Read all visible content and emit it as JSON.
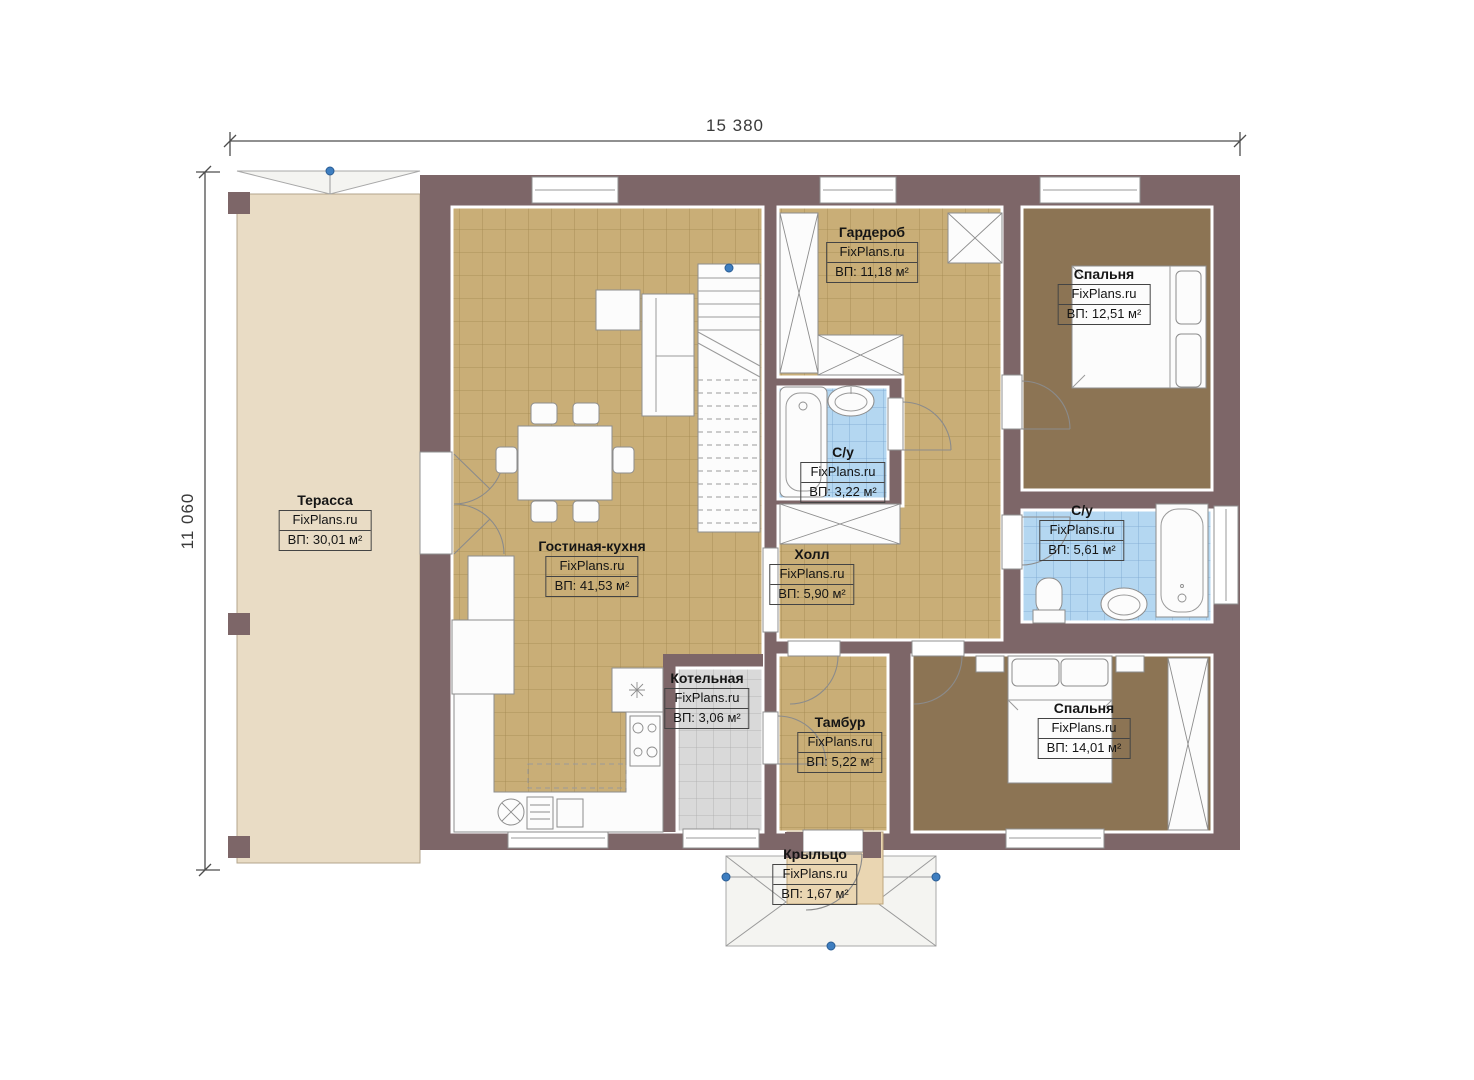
{
  "dimensions": {
    "width_label": "15 380",
    "height_label": "11 060"
  },
  "watermark": "FixPlans.ru",
  "rooms": [
    {
      "name": "Терасса",
      "brand": "FixPlans.ru",
      "area": "ВП: 30,01 м²"
    },
    {
      "name": "Гостиная-кухня",
      "brand": "FixPlans.ru",
      "area": "ВП: 41,53 м²"
    },
    {
      "name": "Гардероб",
      "brand": "FixPlans.ru",
      "area": "ВП: 11,18 м²"
    },
    {
      "name": "Спальня",
      "brand": "FixPlans.ru",
      "area": "ВП: 12,51 м²"
    },
    {
      "name": "С/у",
      "brand": "FixPlans.ru",
      "area": "ВП: 3,22 м²"
    },
    {
      "name": "С/у",
      "brand": "FixPlans.ru",
      "area": "ВП: 5,61 м²"
    },
    {
      "name": "Холл",
      "brand": "FixPlans.ru",
      "area": "ВП: 5,90 м²"
    },
    {
      "name": "Котельная",
      "brand": "FixPlans.ru",
      "area": "ВП: 3,06 м²"
    },
    {
      "name": "Тамбур",
      "brand": "FixPlans.ru",
      "area": "ВП: 5,22 м²"
    },
    {
      "name": "Спальня",
      "brand": "FixPlans.ru",
      "area": "ВП: 14,01 м²"
    },
    {
      "name": "Крыльцо",
      "brand": "FixPlans.ru",
      "area": "ВП: 1,67 м²"
    }
  ],
  "colors": {
    "wall": "#7d6668",
    "floor_tan": "#c9ae77",
    "tile_line_tan": "#a2884f",
    "floor_carpet": "#8c7454",
    "floor_tile_blue": "#b4d7f1",
    "tile_line_blue": "#7aa6cf",
    "floor_tile_gray": "#d9d9d9",
    "tile_line_gray": "#adadad",
    "terrace_floor": "#e9dcc5",
    "porch_floor": "#ead6b2",
    "roof_light": "#f4f4f1",
    "marker_blue": "#3e7ec0"
  }
}
